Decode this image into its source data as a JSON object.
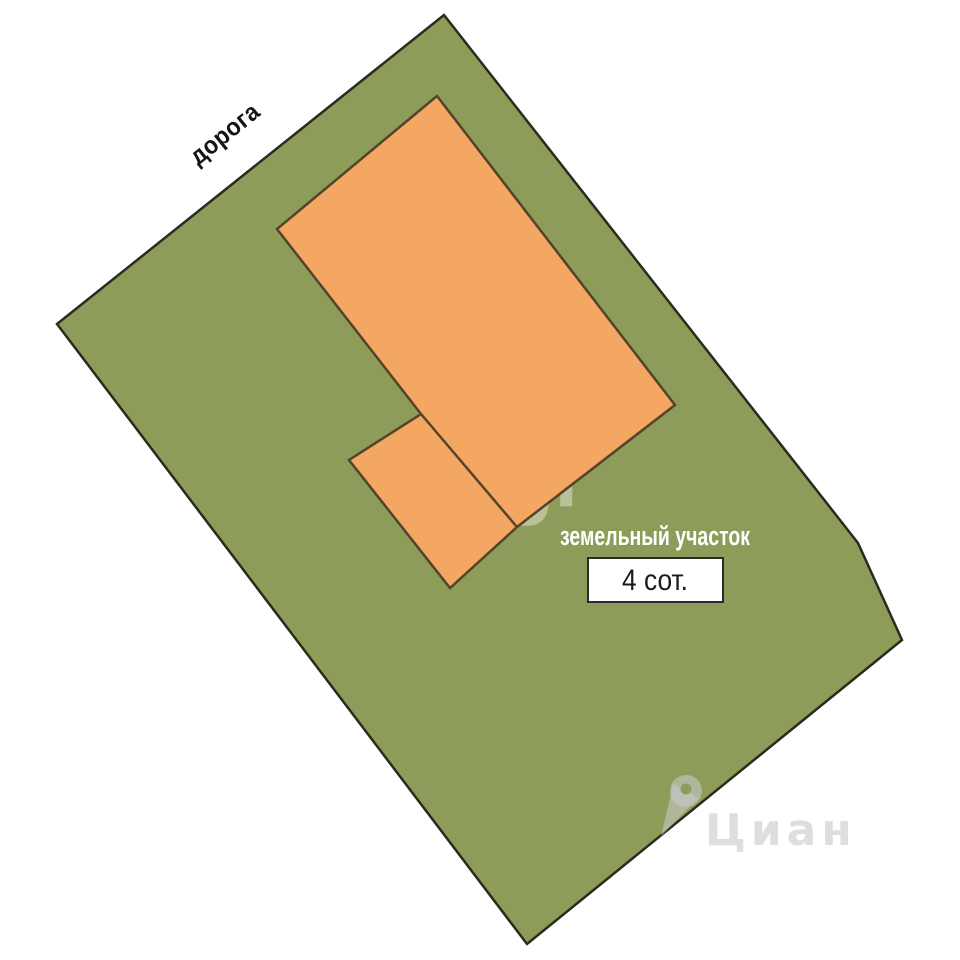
{
  "scene": {
    "road_label": "дорога",
    "plot_label": "земельный участок",
    "area_value": "4 сот.",
    "watermark_center": "etagi",
    "watermark_corner": "Циан"
  },
  "colors": {
    "background": "#FFFFFF",
    "plot_fill": "#8D9C58",
    "plot_border": "#2B2B1D",
    "building_fill": "#F3A763",
    "building_border": "#54432A",
    "area_box_fill": "#FFFFFF",
    "area_box_border": "#2B2B2B",
    "road_text": "#141414",
    "plot_label_text": "#FFFFFF",
    "area_text": "#1A1A1A",
    "watermark_white": "#FFFFFF",
    "watermark_gray": "#C8C8C8"
  }
}
